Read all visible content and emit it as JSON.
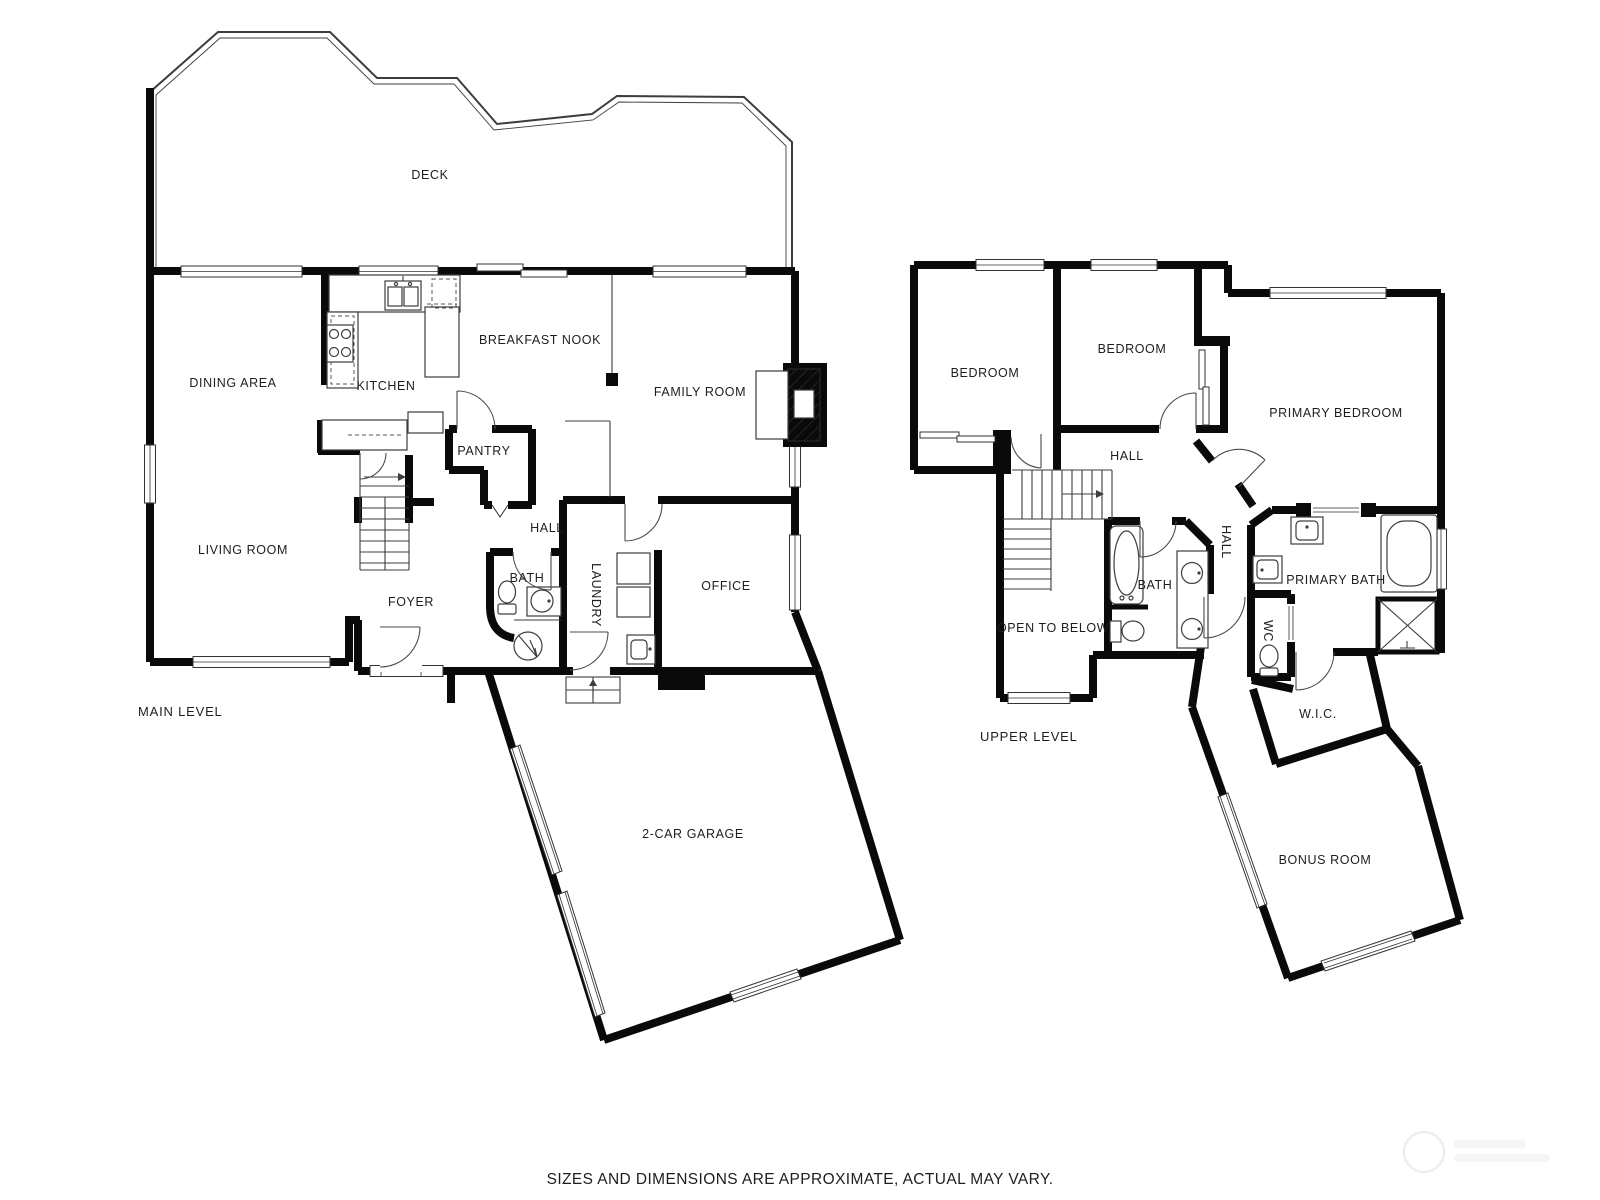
{
  "page": {
    "background": "#ffffff",
    "footer_disclaimer": "SIZES AND DIMENSIONS ARE APPROXIMATE, ACTUAL MAY VARY."
  },
  "colors": {
    "wall": "#0a0a0a",
    "line": "#3d3d3d",
    "text": "#1e1e1e",
    "watermark": "#efefef"
  },
  "main_level": {
    "title": "MAIN LEVEL",
    "rooms": {
      "deck": "DECK",
      "dining_area": "DINING AREA",
      "kitchen": "KITCHEN",
      "breakfast_nook": "BREAKFAST NOOK",
      "family_room": "FAMILY ROOM",
      "pantry": "PANTRY",
      "hall": "HALL",
      "living_room": "LIVING ROOM",
      "foyer": "FOYER",
      "bath": "BATH",
      "laundry": "LAUNDRY",
      "office": "OFFICE",
      "garage": "2-CAR GARAGE"
    }
  },
  "upper_level": {
    "title": "UPPER LEVEL",
    "rooms": {
      "bedroom_left": "BEDROOM",
      "bedroom_middle": "BEDROOM",
      "primary_bedroom": "PRIMARY BEDROOM",
      "hall": "HALL",
      "hall_lower": "HALL",
      "bath": "BATH",
      "primary_bath": "PRIMARY BATH",
      "wc": "WC",
      "open_to_below": "OPEN TO BELOW",
      "wic": "W.I.C.",
      "bonus_room": "BONUS ROOM"
    }
  }
}
